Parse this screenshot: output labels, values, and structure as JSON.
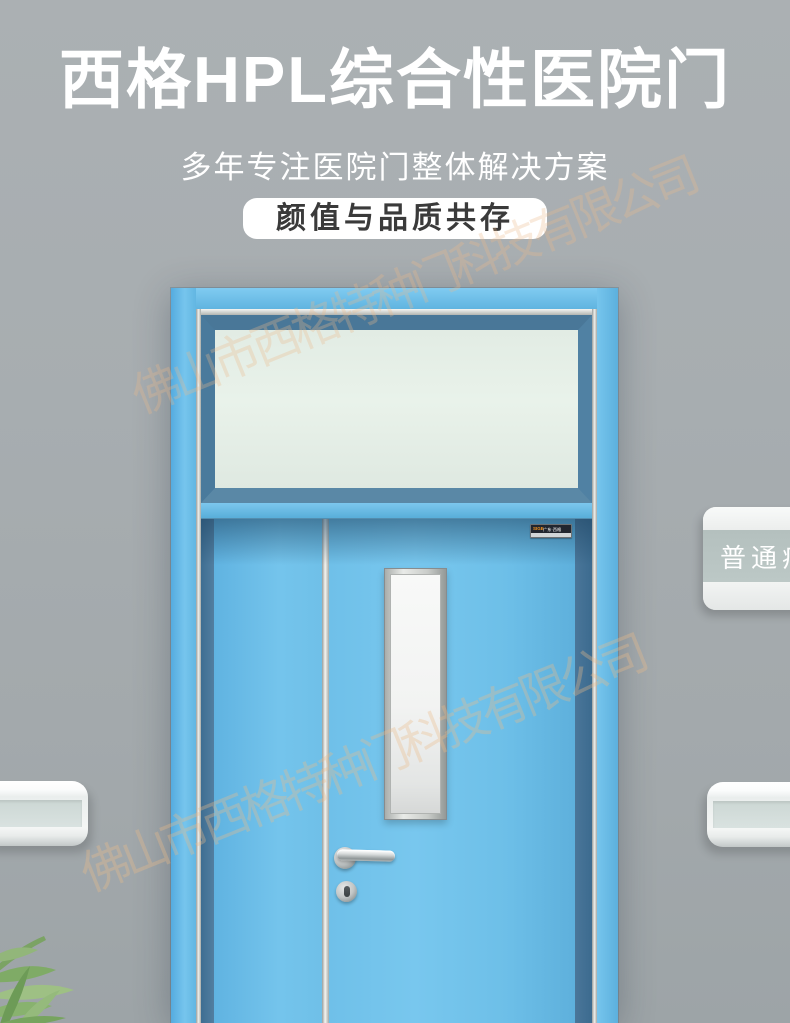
{
  "header": {
    "title": "西格HPL综合性医院门",
    "subtitle": "多年专注医院门整体解决方案",
    "badge": "颜值与品质共存"
  },
  "watermark": {
    "company": "佛山市西格特种门科技有限公司"
  },
  "door": {
    "brand_plate": {
      "mark": "SIGE",
      "name": "广东·西格",
      "subtext": "西格特种门科技有限公司"
    },
    "room_sign": {
      "label": "普通病房"
    }
  },
  "colors": {
    "wall_gray": "#a6acaf",
    "door_blue": "#6fc0e9",
    "steel_blue_frame": "#4e80a2",
    "transom_glass": "#e6efe8",
    "vision_glass": "#f2f3f2",
    "silver_trim": "#d9dad6",
    "watermark_orange": "#ebbb8a",
    "badge_background": "#ffffff",
    "badge_text": "#3a3a3a",
    "sign_band": "#b9c5c3",
    "brand_mark_orange": "#f5921e"
  }
}
